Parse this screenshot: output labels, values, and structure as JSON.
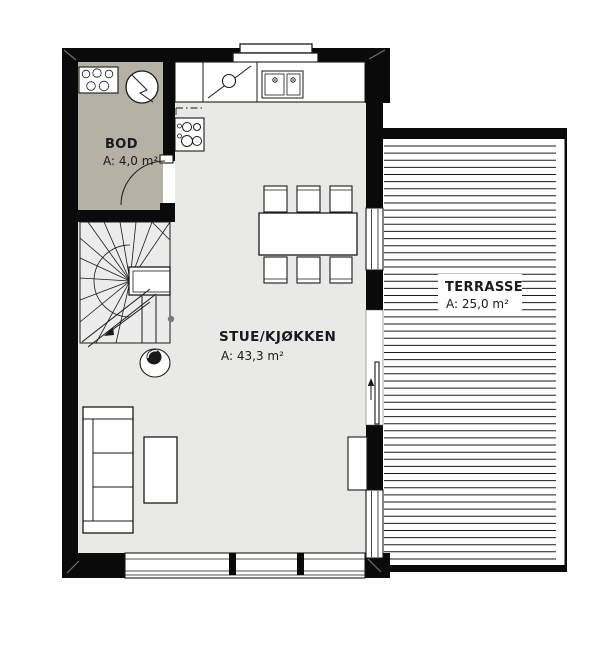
{
  "rooms": {
    "bod": {
      "name": "BOD",
      "area": "A: 4,0 m²"
    },
    "stue": {
      "name": "STUE/KJØKKEN",
      "area": "A: 43,3 m²"
    },
    "terrasse": {
      "name": "TERRASSE",
      "area": "A: 25,0 m²"
    }
  },
  "colors": {
    "wall": "#0a0a0a",
    "bod_floor": "#b5b1a5",
    "main_floor": "#e9e9e8",
    "stair_floor": "#ececec",
    "line": "#1a1a1a",
    "text": "#191922",
    "accent_dot": "#7a7a7a"
  },
  "fixtures": [
    "washing-machine-icon",
    "storage-hob-icon",
    "cooktop-icon",
    "dishwasher-icon",
    "double-sink-icon",
    "dining-table-icon",
    "chair-icon",
    "sofa-icon",
    "coffee-table-icon",
    "tv-bench-icon",
    "round-chair-icon",
    "winder-staircase-icon",
    "door-swing-icon",
    "sliding-door-icon",
    "window-icon",
    "terrace-decking-icon"
  ]
}
